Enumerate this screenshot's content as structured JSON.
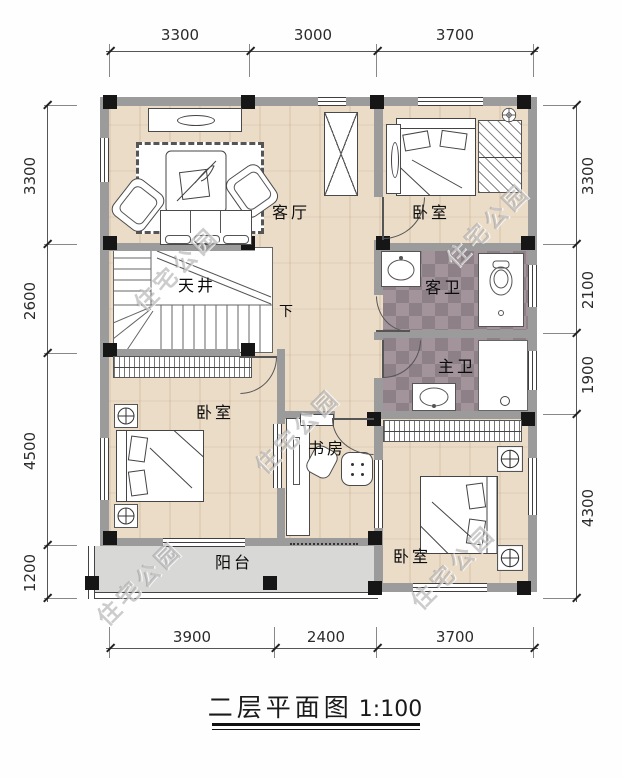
{
  "title": {
    "text": "二层平面图",
    "scale": "1:100"
  },
  "watermark_text": "住宅公园",
  "dimensions": {
    "top": [
      "3300",
      "3000",
      "3700"
    ],
    "bottom": [
      "3900",
      "2400",
      "3700"
    ],
    "left": [
      "3300",
      "2600",
      "4500",
      "1200"
    ],
    "right": [
      "3300",
      "2100",
      "1900",
      "4300"
    ]
  },
  "rooms": {
    "living": "客厅",
    "bedroom_top_right": "卧室",
    "atrium": "天井",
    "guest_bath": "客卫",
    "master_bath": "主卫",
    "bedroom_left": "卧室",
    "study": "书房",
    "bedroom_bottom_right": "卧室",
    "balcony": "阳台"
  },
  "annotations": {
    "stairs_down": "下"
  },
  "colors": {
    "wall": "#9b9b9b",
    "column": "#161616",
    "wood_floor": "#ebdcc8",
    "tile_dark": "#8d8086",
    "tile_light": "#a2949a",
    "balcony_floor": "#d8d8d7",
    "line": "#555555"
  }
}
